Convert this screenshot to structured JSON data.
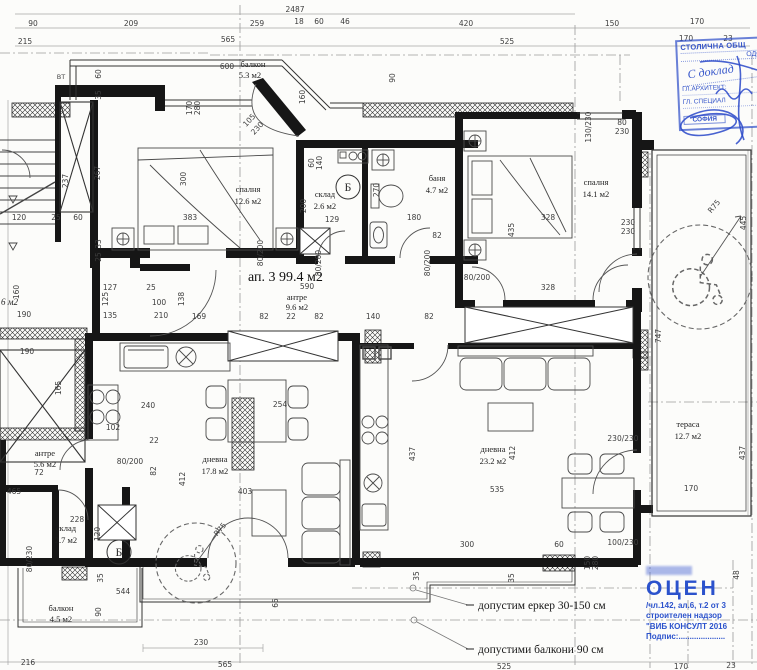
{
  "title": "ап. 3  99.4 м2",
  "rooms": [
    {
      "name": "балкон",
      "area": "5.3 м2"
    },
    {
      "name": "спалня",
      "area": "12.6 м2"
    },
    {
      "name": "склад",
      "area": "2.6 м2"
    },
    {
      "name": "баня",
      "area": "4.7 м2"
    },
    {
      "name": "спалня",
      "area": "14.1 м2"
    },
    {
      "name": "антре",
      "area": "9.6 м2"
    },
    {
      "name": "антре",
      "area": "5.6 м2"
    },
    {
      "name": "склад",
      "area": "2.7 м2"
    },
    {
      "name": "дневна",
      "area": "17.8 м2"
    },
    {
      "name": "дневна",
      "area": "23.2 м2"
    },
    {
      "name": "балкон",
      "area": "4.5 м2"
    },
    {
      "name": "тераса",
      "area": "12.7 м2"
    }
  ],
  "labels": {
    "shaft": "Б",
    "vt": "ВТ",
    "neighbor": "6 м2"
  },
  "annotations": {
    "note1": "допустим еркер 30-150 см",
    "note2": "допустими балкони 90 см"
  },
  "stamp_top": {
    "l1": "СТОЛИЧНА ОБЩ",
    "l2": "ОДО",
    "hand": "С доклад",
    "l3": "ГЛ.АРХИТЕКТ:",
    "l4": "ГЛ. СПЕЦИАЛ",
    "l5": "СОФИЯ"
  },
  "stamp_bottom": {
    "big": "ОЦЕН",
    "l1": "/чл.142, ал.6, т.2 от 3",
    "l2": "строителен надзор",
    "l3": "\"ВИБ КОНСУЛТ 2016",
    "l4": "Подпис:....................."
  },
  "colors": {
    "stamp_blue": "#2b52cc",
    "wall_black": "#161616",
    "dim_gray": "#3d3d3d"
  },
  "dims": [
    {
      "t": "2487",
      "x": 295,
      "y": 12
    },
    {
      "t": "90",
      "x": 33,
      "y": 26
    },
    {
      "t": "209",
      "x": 131,
      "y": 26
    },
    {
      "t": "259",
      "x": 257,
      "y": 26
    },
    {
      "t": "18",
      "x": 299,
      "y": 24
    },
    {
      "t": "60",
      "x": 319,
      "y": 24
    },
    {
      "t": "46",
      "x": 345,
      "y": 24
    },
    {
      "t": "420",
      "x": 466,
      "y": 26
    },
    {
      "t": "150",
      "x": 612,
      "y": 26
    },
    {
      "t": "170",
      "x": 697,
      "y": 24
    },
    {
      "t": "215",
      "x": 25,
      "y": 44
    },
    {
      "t": "565",
      "x": 228,
      "y": 42
    },
    {
      "t": "525",
      "x": 507,
      "y": 44
    },
    {
      "t": "170",
      "x": 686,
      "y": 41
    },
    {
      "t": "23",
      "x": 728,
      "y": 41
    },
    {
      "t": "600",
      "x": 227,
      "y": 69
    },
    {
      "t": "60",
      "x": 101,
      "y": 74,
      "r": -90
    },
    {
      "t": "35",
      "x": 101,
      "y": 95,
      "r": -90
    },
    {
      "t": "267",
      "x": 100,
      "y": 173,
      "r": -90
    },
    {
      "t": "237",
      "x": 68,
      "y": 181,
      "r": -90
    },
    {
      "t": "300",
      "x": 186,
      "y": 179,
      "r": -90
    },
    {
      "t": "383",
      "x": 190,
      "y": 220
    },
    {
      "t": "120",
      "x": 19,
      "y": 220
    },
    {
      "t": "25",
      "x": 56,
      "y": 220
    },
    {
      "t": "60",
      "x": 78,
      "y": 220
    },
    {
      "t": "33",
      "x": 101,
      "y": 244,
      "r": -90
    },
    {
      "t": "25",
      "x": 101,
      "y": 257,
      "r": -90
    },
    {
      "t": "170",
      "x": 192,
      "y": 108,
      "r": -90
    },
    {
      "t": "280",
      "x": 200,
      "y": 108,
      "r": -90
    },
    {
      "t": "105",
      "x": 251,
      "y": 122,
      "r": -47
    },
    {
      "t": "230",
      "x": 259,
      "y": 130,
      "r": -47
    },
    {
      "t": "160",
      "x": 305,
      "y": 97,
      "r": -90
    },
    {
      "t": "90",
      "x": 395,
      "y": 78,
      "r": -90
    },
    {
      "t": "160",
      "x": 19,
      "y": 292,
      "r": -90
    },
    {
      "t": "125",
      "x": 108,
      "y": 299,
      "r": -90
    },
    {
      "t": "190",
      "x": 24,
      "y": 317
    },
    {
      "t": "190",
      "x": 27,
      "y": 354
    },
    {
      "t": "165",
      "x": 61,
      "y": 388,
      "r": -90
    },
    {
      "t": "60",
      "x": 314,
      "y": 163,
      "r": -90
    },
    {
      "t": "140",
      "x": 322,
      "y": 163,
      "r": -90
    },
    {
      "t": "200",
      "x": 306,
      "y": 206,
      "r": -90
    },
    {
      "t": "129",
      "x": 332,
      "y": 222
    },
    {
      "t": "270",
      "x": 379,
      "y": 190,
      "r": -90
    },
    {
      "t": "180",
      "x": 414,
      "y": 220
    },
    {
      "t": "82",
      "x": 437,
      "y": 238
    },
    {
      "t": "130/230",
      "x": 591,
      "y": 127,
      "r": -90
    },
    {
      "t": "80",
      "x": 622,
      "y": 125
    },
    {
      "t": "230",
      "x": 622,
      "y": 134
    },
    {
      "t": "328",
      "x": 548,
      "y": 220
    },
    {
      "t": "435",
      "x": 514,
      "y": 230,
      "r": -90
    },
    {
      "t": "230",
      "x": 628,
      "y": 225
    },
    {
      "t": "230",
      "x": 628,
      "y": 234
    },
    {
      "t": "328",
      "x": 548,
      "y": 290
    },
    {
      "t": "127",
      "x": 110,
      "y": 290
    },
    {
      "t": "25",
      "x": 151,
      "y": 290
    },
    {
      "t": "100",
      "x": 159,
      "y": 305
    },
    {
      "t": "210",
      "x": 161,
      "y": 318
    },
    {
      "t": "135",
      "x": 110,
      "y": 318
    },
    {
      "t": "169",
      "x": 199,
      "y": 319
    },
    {
      "t": "138",
      "x": 184,
      "y": 299,
      "r": -90
    },
    {
      "t": "82",
      "x": 264,
      "y": 319
    },
    {
      "t": "22",
      "x": 291,
      "y": 319
    },
    {
      "t": "82",
      "x": 319,
      "y": 319
    },
    {
      "t": "140",
      "x": 373,
      "y": 319
    },
    {
      "t": "82",
      "x": 429,
      "y": 319
    },
    {
      "t": "590",
      "x": 307,
      "y": 289
    },
    {
      "t": "80/200",
      "x": 263,
      "y": 253,
      "r": -90
    },
    {
      "t": "80/200",
      "x": 321,
      "y": 263,
      "r": -90
    },
    {
      "t": "80/200",
      "x": 430,
      "y": 263,
      "r": -90
    },
    {
      "t": "80/200",
      "x": 477,
      "y": 280
    },
    {
      "t": "240",
      "x": 148,
      "y": 408
    },
    {
      "t": "254",
      "x": 280,
      "y": 407
    },
    {
      "t": "102",
      "x": 113,
      "y": 430
    },
    {
      "t": "22",
      "x": 154,
      "y": 443
    },
    {
      "t": "82",
      "x": 156,
      "y": 471,
      "r": -90
    },
    {
      "t": "80/200",
      "x": 130,
      "y": 464
    },
    {
      "t": "412",
      "x": 185,
      "y": 479,
      "r": -90
    },
    {
      "t": "403",
      "x": 245,
      "y": 494
    },
    {
      "t": "R75",
      "x": 222,
      "y": 531,
      "r": -50
    },
    {
      "t": "465",
      "x": 14,
      "y": 494
    },
    {
      "t": "72",
      "x": 39,
      "y": 475
    },
    {
      "t": "228",
      "x": 77,
      "y": 522
    },
    {
      "t": "120",
      "x": 100,
      "y": 534,
      "r": -90
    },
    {
      "t": "80/230",
      "x": 32,
      "y": 559,
      "r": -90
    },
    {
      "t": "35",
      "x": 103,
      "y": 578,
      "r": -90
    },
    {
      "t": "544",
      "x": 123,
      "y": 594
    },
    {
      "t": "90",
      "x": 101,
      "y": 612,
      "r": -90
    },
    {
      "t": "216",
      "x": 28,
      "y": 665
    },
    {
      "t": "230",
      "x": 201,
      "y": 645
    },
    {
      "t": "565",
      "x": 225,
      "y": 667
    },
    {
      "t": "437",
      "x": 415,
      "y": 454,
      "r": -90
    },
    {
      "t": "412",
      "x": 515,
      "y": 453,
      "r": -90
    },
    {
      "t": "535",
      "x": 497,
      "y": 492
    },
    {
      "t": "300",
      "x": 467,
      "y": 547
    },
    {
      "t": "60",
      "x": 559,
      "y": 547
    },
    {
      "t": "100/230",
      "x": 623,
      "y": 545
    },
    {
      "t": "230/230",
      "x": 623,
      "y": 441
    },
    {
      "t": "35",
      "x": 419,
      "y": 576,
      "r": -90
    },
    {
      "t": "35",
      "x": 514,
      "y": 578,
      "r": -90
    },
    {
      "t": "150",
      "x": 590,
      "y": 563,
      "r": -90
    },
    {
      "t": "280",
      "x": 598,
      "y": 563,
      "r": -90
    },
    {
      "t": "65",
      "x": 278,
      "y": 603,
      "r": -90
    },
    {
      "t": "747",
      "x": 661,
      "y": 336,
      "r": -90
    },
    {
      "t": "445",
      "x": 746,
      "y": 223,
      "r": -90
    },
    {
      "t": "437",
      "x": 745,
      "y": 453,
      "r": -90
    },
    {
      "t": "170",
      "x": 691,
      "y": 491
    },
    {
      "t": "48",
      "x": 739,
      "y": 575,
      "r": -90
    },
    {
      "t": "525",
      "x": 504,
      "y": 669
    },
    {
      "t": "170",
      "x": 681,
      "y": 669
    },
    {
      "t": "23",
      "x": 731,
      "y": 668
    },
    {
      "t": "R75",
      "x": 716,
      "y": 208,
      "r": -50
    }
  ]
}
